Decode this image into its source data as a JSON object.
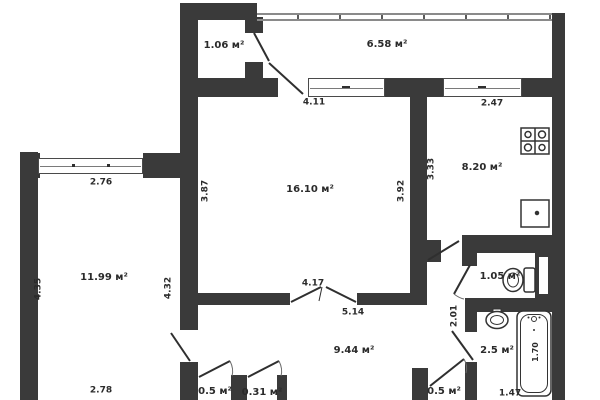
{
  "plan": {
    "type": "apartment-floor-plan",
    "area_unit": "м²",
    "rooms": {
      "balcony_small": "1.06 м²",
      "balcony": "6.58 м²",
      "living_room": "16.10 м²",
      "kitchen": "8.20 м²",
      "bedroom": "11.99 м²",
      "wc": "1.05 м²",
      "hallway": "9.44 м²",
      "bathroom": "2.5 м²",
      "closet_left": "0.5 м²",
      "closet_mid": "0.31 м²",
      "closet_right": "0.5 м²"
    },
    "dims": {
      "top_window_living": "4.11",
      "top_window_kitchen": "2.47",
      "bedroom_window": "2.76",
      "living_left": "3.87",
      "living_right": "3.92",
      "kitchen_left": "3.33",
      "bedroom_left": "4.35",
      "bedroom_right": "4.32",
      "living_door": "4.17",
      "hall_top": "5.14",
      "corridor": "2.01",
      "bedroom_bottom": "2.78",
      "bath_bottom": "1.47",
      "tub_length": "1.70"
    },
    "fixtures": [
      "stove-icon",
      "kitchen-sink-icon",
      "toilet-icon",
      "washbasin-icon",
      "bathtub-icon"
    ],
    "colors": {
      "wall": "#3a3a3a",
      "line": "#2f2f2f",
      "text": "#2b2b2b",
      "background": "#ffffff"
    }
  }
}
